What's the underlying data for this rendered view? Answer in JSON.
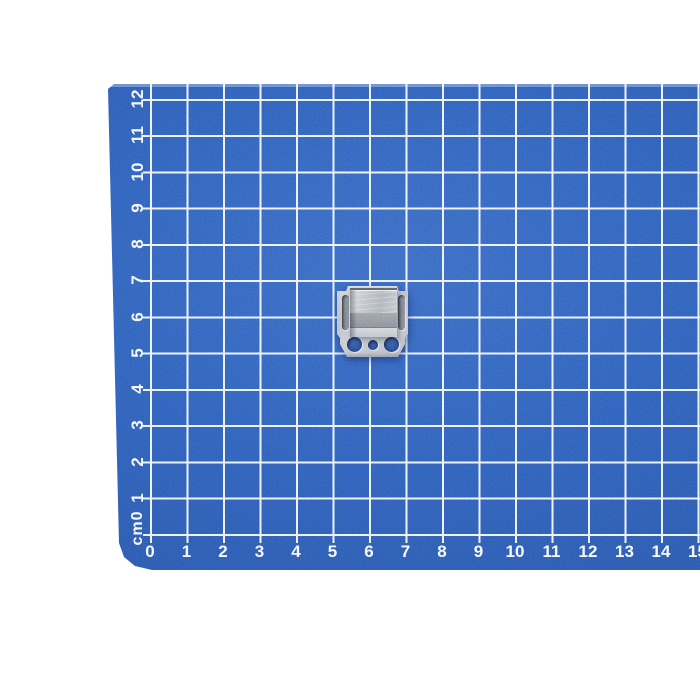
{
  "mat": {
    "unit_label": "cm0",
    "left_ruler_numbers": [
      "12",
      "11",
      "10",
      "9",
      "8",
      "7",
      "6",
      "5",
      "4",
      "3",
      "2",
      "1"
    ],
    "bottom_ruler_numbers": [
      "0",
      "1",
      "2",
      "3",
      "4",
      "5",
      "6",
      "7",
      "8",
      "9",
      "10",
      "11",
      "12",
      "13",
      "14",
      "15"
    ],
    "colors": {
      "mat_blue": "#2f5db8",
      "mat_blue_dark_edge": "#264f9f",
      "grid_line": "#edf1f7",
      "ruler_text": "#f4f7fb"
    }
  },
  "part": {
    "name": "metal clip bracket",
    "colors": {
      "plate_gray": "#c0c4ca",
      "box_face_gray": "#8b9097",
      "box_lip_gray": "#d2d5d9",
      "slot_gray": "#676c76",
      "hole_blue": "#2c4e96"
    }
  }
}
